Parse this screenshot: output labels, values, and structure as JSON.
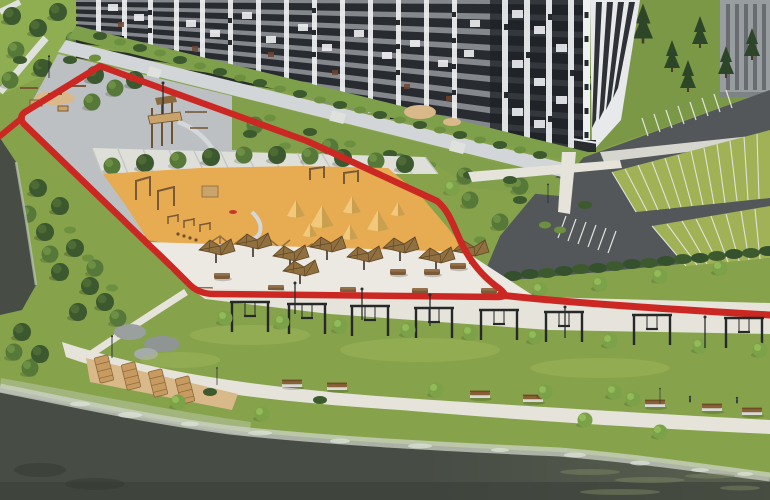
{
  "scene": {
    "type": "architectural-3d-render",
    "description": "Aerial 3D visualization of a residential courtyard: dark checkered apartment block, sandy kids playground with wooden equipment and sand cones, white pebble lounge plaza with timber canopies, red jogging track loop with a row of black swing frames, green eco-parking with white stall stripes, tree rows, and a waterfront promenade with benches beside dark water",
    "areas": {
      "building": "apartment-building",
      "playground": "sand-playground",
      "lounge": "pebble-lounge-plaza",
      "track": "red-jogging-track",
      "swings": "swing-frame-row",
      "parking": "eco-parking",
      "promenade": "waterfront-promenade",
      "water": "river"
    },
    "counts": {
      "swing_frames": 8,
      "canopies": 9,
      "benches": 7,
      "stepped_seats": 4,
      "sand_cones": 7
    }
  },
  "colors": {
    "grass_base": "#86a24b",
    "grass_bright": "#9ab656",
    "lawn_far": "#7b9847",
    "strip_green": "#82a04c",
    "bush_strip": "#7fa04a",
    "water": "#474c45",
    "water_deep": "#3b3f39",
    "foam": "#ccd3c5",
    "sand": "#e7ab52",
    "tan_patch": "#d9b98a",
    "plaza": "#bcc0c3",
    "striped_paving": "#dfdfda",
    "pebble": "#ebe9e1",
    "path_light": "#e6e4da",
    "sidewalk": "#d3d6d8",
    "asphalt": "#53575a",
    "stall_green": "#a0b156",
    "line_white": "#dfe3da",
    "track_red": "#cb2823",
    "bldg_main": "#84888c",
    "bldg_face2": "#34383c",
    "bldg_side": "#e7e9ea",
    "bldg_base": "#73777a",
    "glass": "#1f2226",
    "panel_white": "#eef0f2",
    "far_bldg": "#989da0",
    "wood": "#a97c4e",
    "canopy": "#91703f",
    "frame_black": "#26282a",
    "band_shore": "#5a614f"
  }
}
